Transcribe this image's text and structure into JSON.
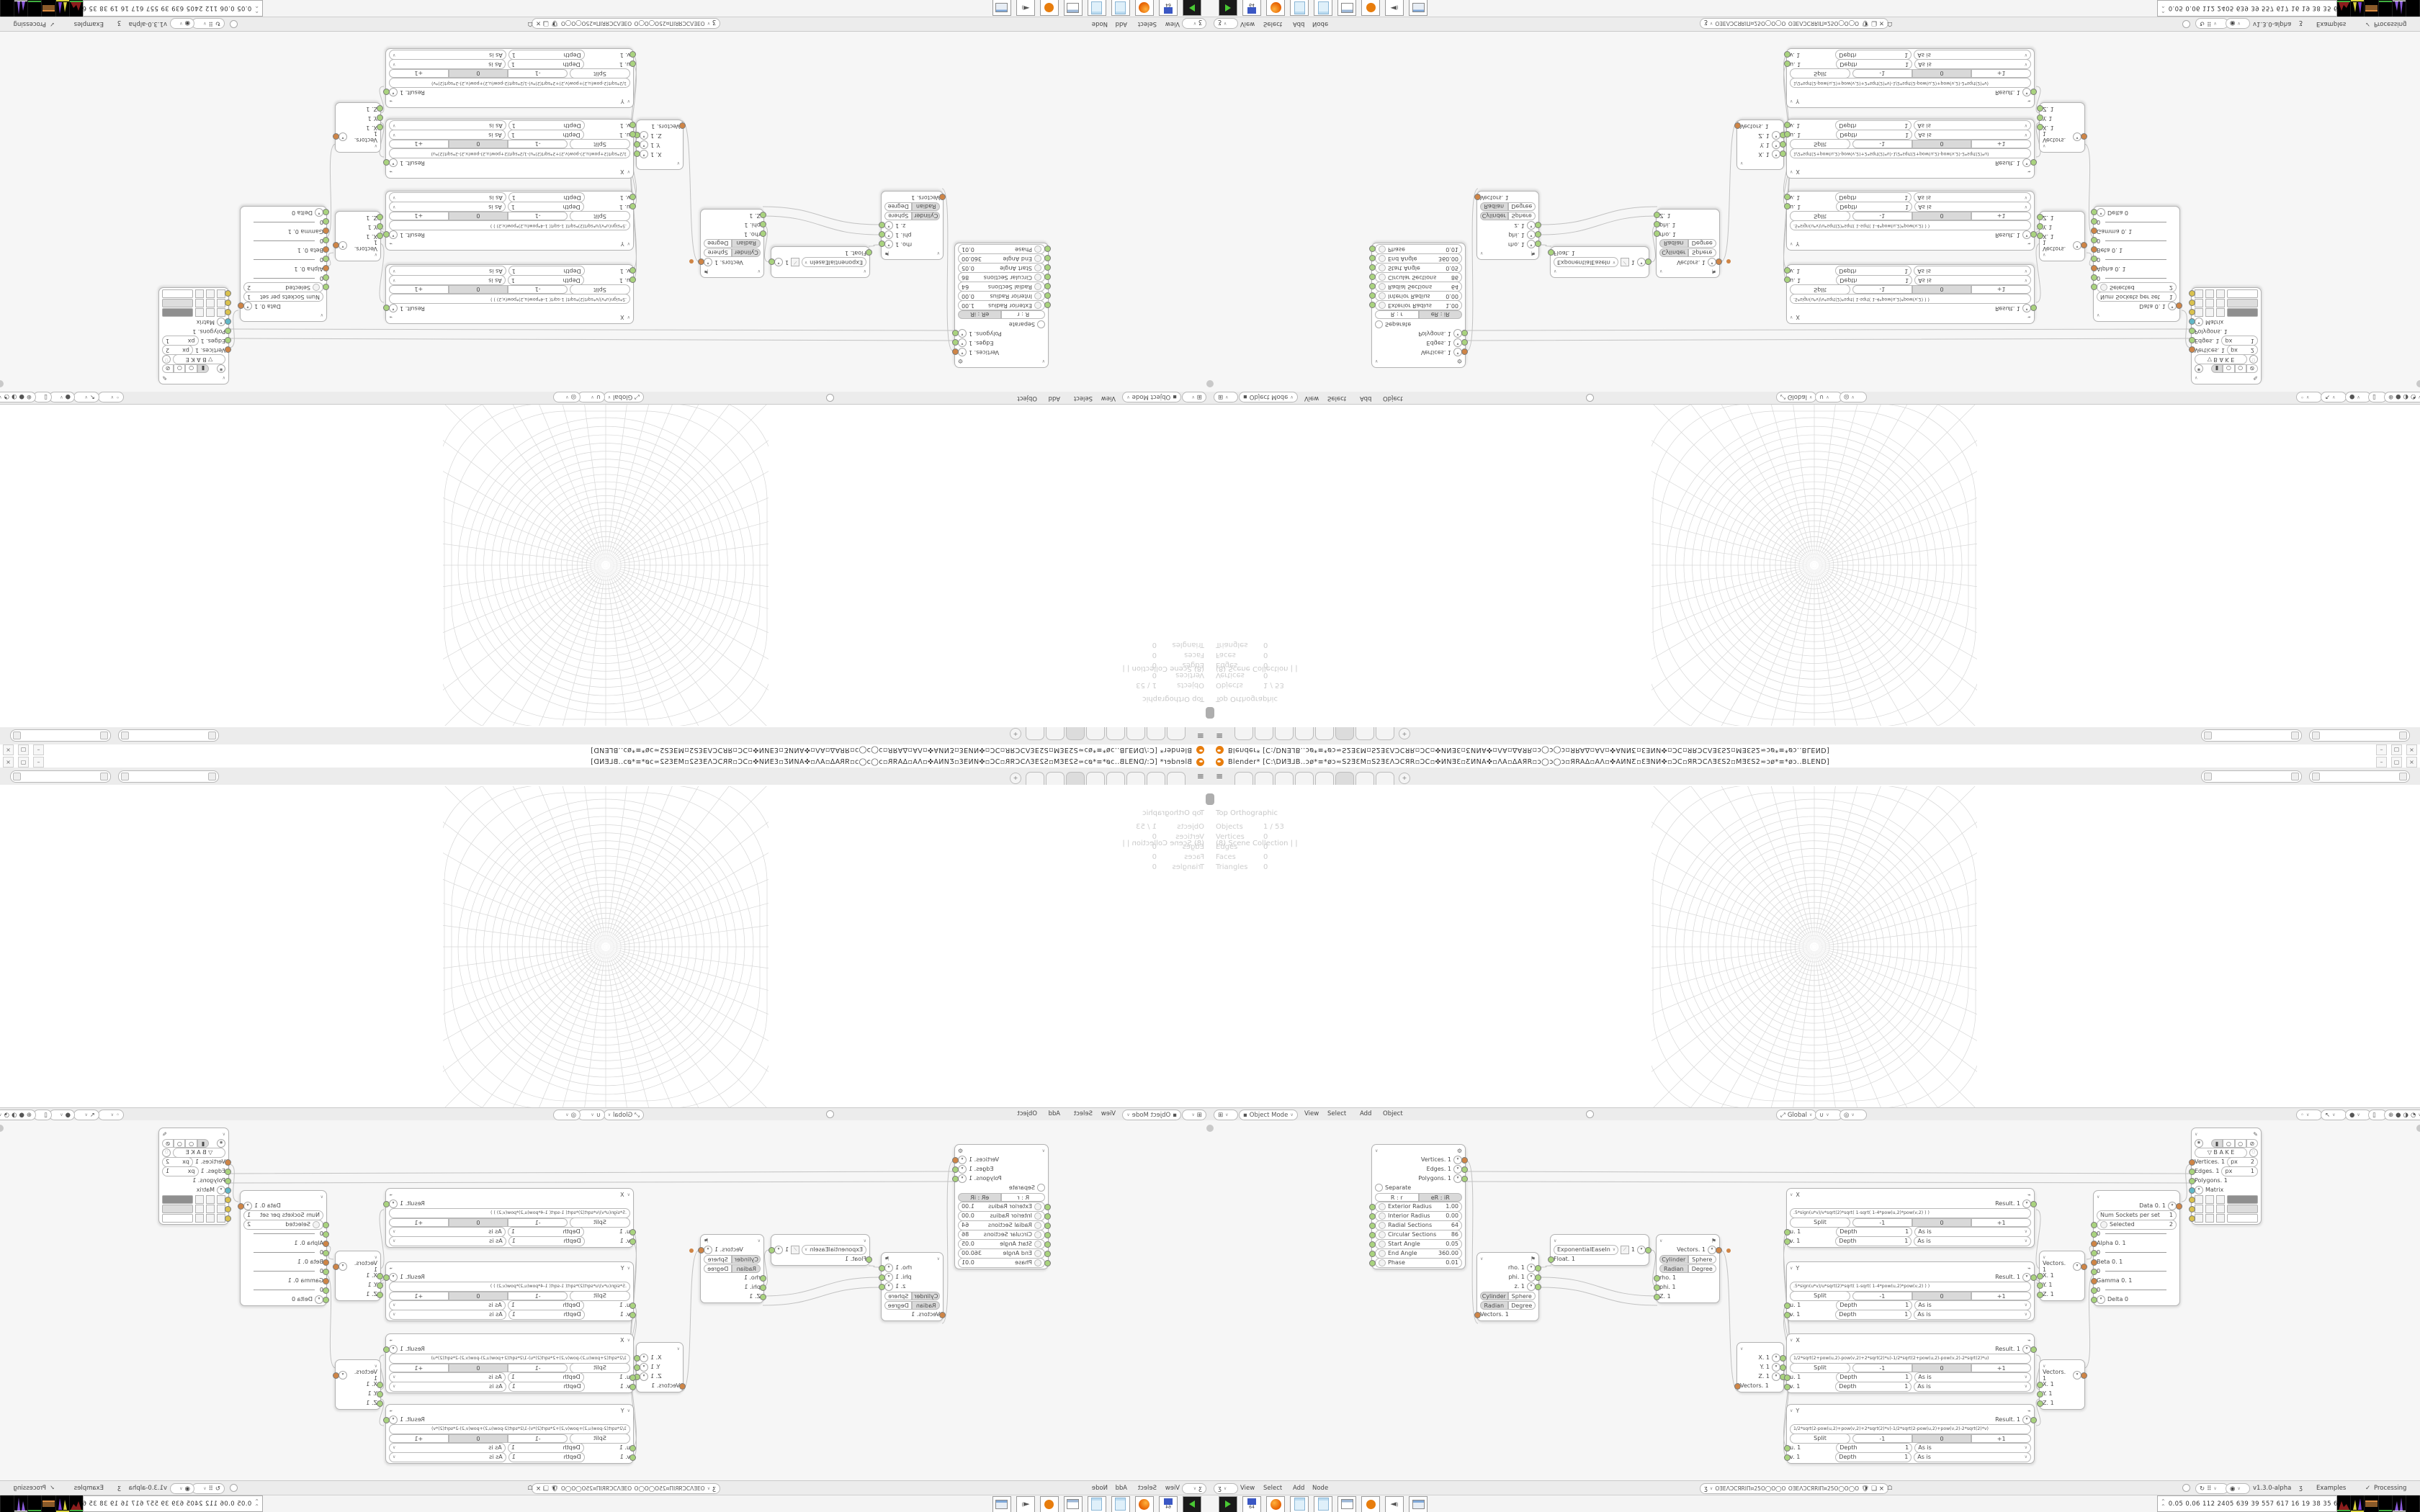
{
  "window": {
    "title": "Blender* [C:\\DИƎ⅃B..ɔø*≡*øɔ≂S2ƎƐM▫S2ƎƐΛƆCЯR▫ƆC▫✜ИNƎƐ▫ƸИNA✜▫ΛA▫ΔAЯR▫ɔ◯ɔ◯ɔ▫ЯRAΔ▫AΛ▫✜AИNƸ▫ƐƎNИ✜▫ƆC▫ЯRƆCΛƎƐS2▫MƎƐS2≂ɔø*≡*øɔ..BLEND]",
    "minimize": "–",
    "maximize": "▢",
    "close": "×"
  },
  "topbar": {
    "tabs": [
      "",
      "",
      "",
      "",
      "",
      "",
      "",
      ""
    ],
    "active_tab_index": 5,
    "add_tab": "+"
  },
  "viewport": {
    "view_label": "Top Orthographic",
    "collection_label": "(8) Scene Collection | |",
    "stats": [
      [
        "Objects",
        "1 / 53"
      ],
      [
        "Vertices",
        "0"
      ],
      [
        "Edges",
        "0"
      ],
      [
        "Faces",
        "0"
      ],
      [
        "Triangles",
        "0"
      ]
    ],
    "header": {
      "mode": "Object Mode",
      "menus": [
        "View",
        "Select",
        "Add",
        "Object"
      ],
      "orientation": "Global"
    }
  },
  "node_editor": {
    "header": {
      "menus": [
        "View",
        "Select",
        "Add",
        "Node"
      ],
      "tree_name": "OƎEΛƆCЯRIΠ¤25O◯O◯O25¤ΠIЯRƆΛƎEO",
      "version": "v1.3.0-alpha",
      "examples_label": "Examples",
      "processing_label": "Processing"
    },
    "torus": {
      "outputs": [
        "Vertices. 1",
        "Edges. 1",
        "Polygons. 1"
      ],
      "separate_label": "Separate",
      "mode_buttons": [
        "R : r",
        "eR : iR"
      ],
      "fields": [
        [
          "Exterior Radius",
          "1.00"
        ],
        [
          "Interior Radius",
          "0.00"
        ],
        [
          "Radial Sections",
          "64"
        ],
        [
          "Circular Sections",
          "86"
        ],
        [
          "Start Angle",
          "0.05"
        ],
        [
          "End Angle",
          "360.00"
        ],
        [
          "Phase",
          "0.01"
        ]
      ]
    },
    "polar_out": {
      "outputs": [
        "rho. 1",
        "phi. 1",
        "z. 1"
      ],
      "toggles": [
        [
          "Cylinder",
          "Sphere"
        ],
        [
          "Radian",
          "Degree"
        ]
      ],
      "input": "Vectors. 1"
    },
    "easing": {
      "mode": "ExponentialEaseIn",
      "value": "1",
      "input": "Float. 1"
    },
    "polar_in": {
      "output": "Vectors. 1",
      "toggles": [
        [
          "Cylinder",
          "Sphere"
        ],
        [
          "Radian",
          "Degree"
        ]
      ],
      "inputs": [
        "rho. 1",
        "phi. 1",
        "Z. 1"
      ]
    },
    "vector_out": {
      "outputs": [
        "X. 1",
        "Y. 1",
        "Z. 1"
      ],
      "input": "Vectors. 1"
    },
    "formula_nodes": [
      {
        "title": "X",
        "formula": ".5*sign(u*v)/v*sqrt(2)*sqrt( 1-sqrt( 1-4*pow(u,2)*pow(v,2) ) )"
      },
      {
        "title": "Y",
        "formula": ".5*sign(u*v)/u*sqrt(2)*sqrt( 1-sqrt( 1-4*pow(u,2)*pow(v,2) ) )"
      },
      {
        "title": "X",
        "formula": "1/2*sqrt(2+pow(u,2)-pow(v,2)+2*sqrt(2)*u)-1/2*sqrt(2+pow(u,2)-pow(v,2)-2*sqrt(2)*u)"
      },
      {
        "title": "Y",
        "formula": "1/2*sqrt(2-pow(u,2)+pow(v,2)+2*sqrt(2)*v)-1/2*sqrt(2-pow(u,2)+pow(v,2)-2*sqrt(2)*v)"
      }
    ],
    "formula_common": {
      "result": "Result. 1",
      "split": "Split",
      "segments": [
        "-1",
        "0",
        "+1"
      ],
      "active_segment": 1,
      "depth_label": "Depth",
      "depth_value": "1",
      "asis_label": "As is",
      "inputs": [
        "u. 1",
        "v. 1"
      ]
    },
    "vector_in": {
      "output": "Vectors. 1",
      "inputs": [
        "X. 1",
        "Y. 1",
        "Z. 1"
      ]
    },
    "data_node": {
      "output": "Data 0. 1",
      "num_sockets": [
        "Num Sockets per set",
        "1"
      ],
      "selected": [
        "Selected",
        "2"
      ],
      "sep_value": "0",
      "inputs": [
        "Alpha 0. 1",
        "Beta 0. 1",
        "Gamma 0. 1"
      ],
      "delta": "Delta 0"
    },
    "viewer_draw": {
      "bake_label": "B A K E",
      "sockets": [
        [
          "Vertices. 1",
          "px",
          "2"
        ],
        [
          "Edges. 1",
          "px",
          "1"
        ],
        [
          "Polygons. 1",
          "",
          ""
        ],
        [
          "Matrix",
          "",
          ""
        ]
      ]
    }
  },
  "taskbar": {
    "stats": "0.05 0.06 112 2405 639  39  557  617  16  19  38  35  62567952"
  },
  "colors": {
    "accent_orange": "#e87d0d",
    "socket_green": "#a9d37e",
    "socket_orange": "#cf8546",
    "socket_cyan": "#62b8c7",
    "socket_yellow": "#d9c14e"
  }
}
